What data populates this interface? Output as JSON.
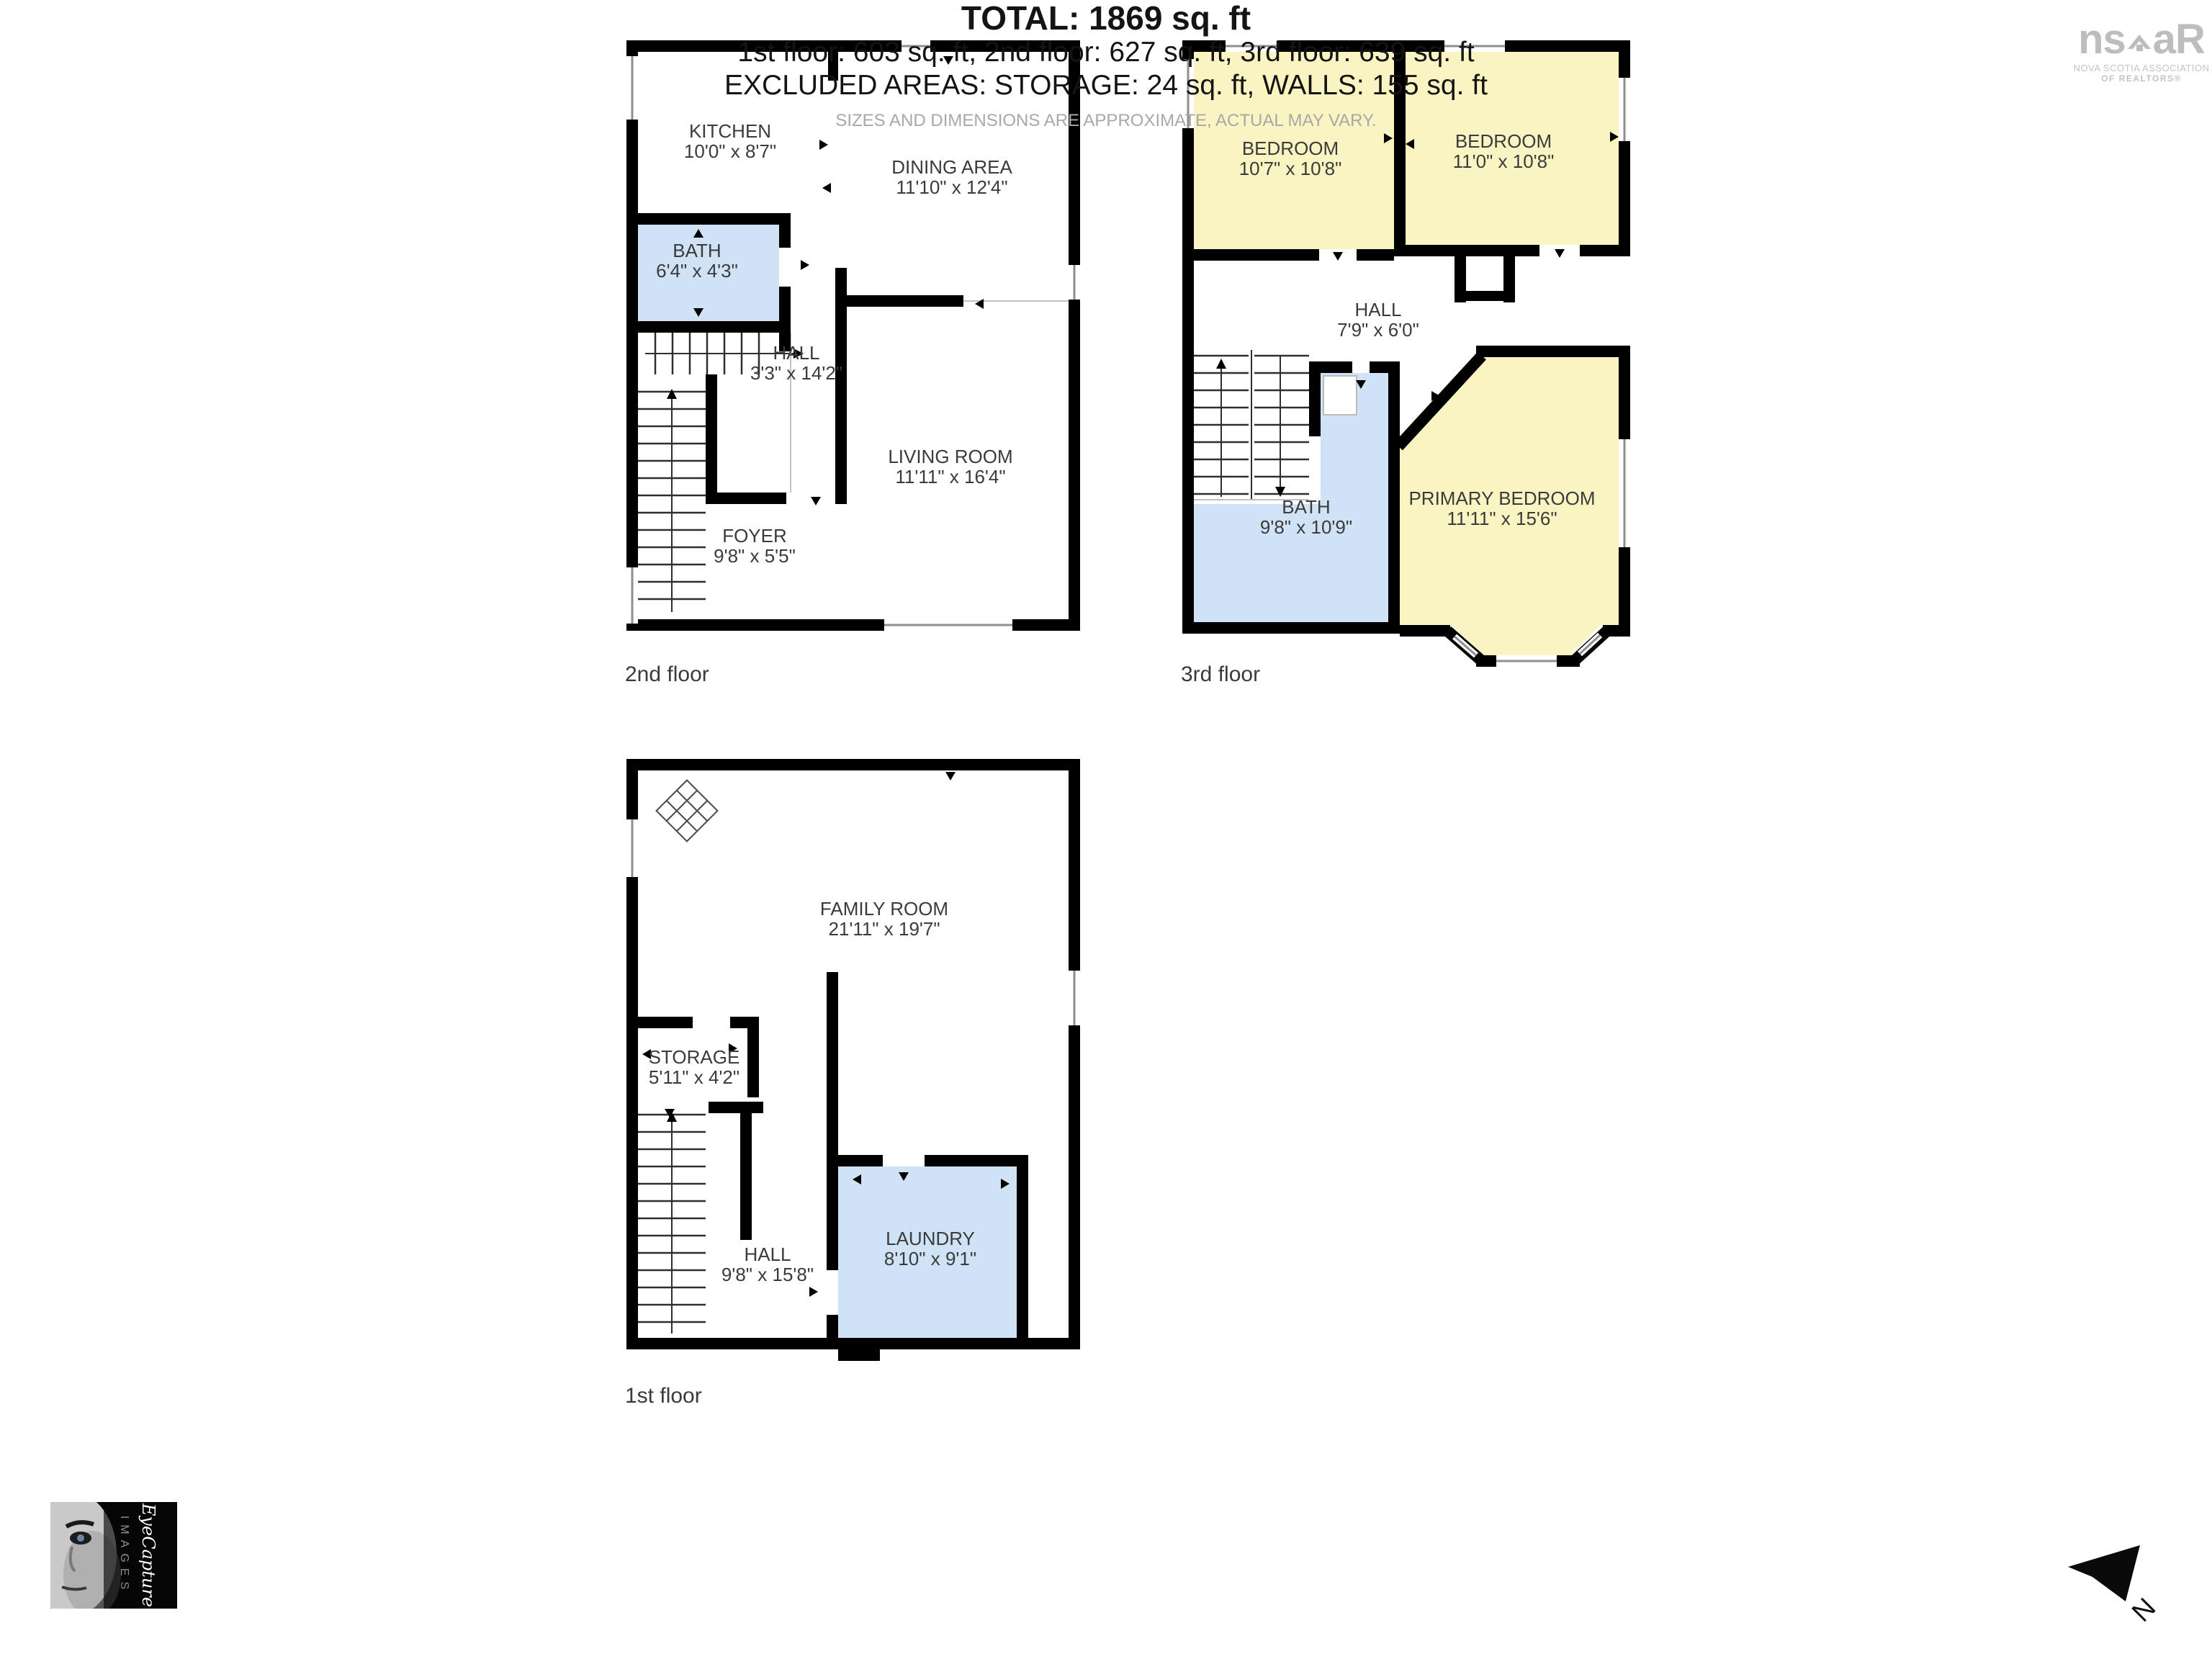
{
  "floors": [
    {
      "label": "2nd floor",
      "rooms": [
        {
          "name": "KITCHEN",
          "dims": "10'0\" x 8'7\""
        },
        {
          "name": "DINING AREA",
          "dims": "11'10\" x 12'4\""
        },
        {
          "name": "BATH",
          "dims": "6'4\" x 4'3\""
        },
        {
          "name": "HALL",
          "dims": "3'3\" x 14'2\""
        },
        {
          "name": "LIVING ROOM",
          "dims": "11'11\" x 16'4\""
        },
        {
          "name": "FOYER",
          "dims": "9'8\" x 5'5\""
        }
      ]
    },
    {
      "label": "3rd floor",
      "rooms": [
        {
          "name": "BEDROOM",
          "dims": "10'7\" x 10'8\""
        },
        {
          "name": "BEDROOM",
          "dims": "11'0\" x 10'8\""
        },
        {
          "name": "HALL",
          "dims": "7'9\" x 6'0\""
        },
        {
          "name": "BATH",
          "dims": "9'8\" x 10'9\""
        },
        {
          "name": "PRIMARY BEDROOM",
          "dims": "11'11\" x 15'6\""
        }
      ]
    },
    {
      "label": "1st floor",
      "rooms": [
        {
          "name": "FAMILY ROOM",
          "dims": "21'11\" x 19'7\""
        },
        {
          "name": "STORAGE",
          "dims": "5'11\" x 4'2\""
        },
        {
          "name": "HALL",
          "dims": "9'8\" x 15'8\""
        },
        {
          "name": "LAUNDRY",
          "dims": "8'10\" x 9'1\""
        }
      ]
    }
  ],
  "summary": {
    "total": "TOTAL: 1869 sq. ft",
    "floors_line": "1st floor: 603 sq. ft, 2nd floor: 627 sq. ft, 3rd floor: 639 sq. ft",
    "excluded_line": "EXCLUDED AREAS: STORAGE: 24 sq. ft, WALLS: 155 sq. ft",
    "disclaimer": "SIZES AND DIMENSIONS ARE APPROXIMATE, ACTUAL MAY VARY."
  },
  "logos": {
    "nsar_prefix": "ns",
    "nsar_suffix": "aR",
    "nsar_sub1": "NOVA SCOTIA ASSOCIATION",
    "nsar_sub2": "OF REALTORS®",
    "credit_script": "EyeCapture",
    "credit_caps": "IMAGES"
  },
  "compass": {
    "label": "N"
  },
  "colors": {
    "bedroom_yellow": "#faf3c2",
    "bath_blue": "#cfe2f6",
    "wall_black": "#000000",
    "disclaimer_gray": "#a8a8a8",
    "logo_gray": "#bdbdbd"
  }
}
